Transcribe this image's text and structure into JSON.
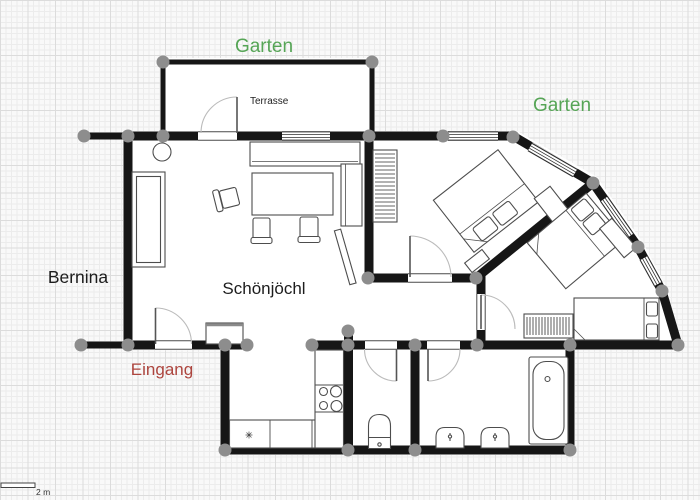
{
  "plan": {
    "labels": {
      "garten_top": {
        "text": "Garten",
        "color": "#56a556"
      },
      "garten_right": {
        "text": "Garten",
        "color": "#56a556"
      },
      "terrasse": {
        "text": "Terrasse",
        "color": "#222222"
      },
      "bernina": {
        "text": "Bernina",
        "color": "#1d1d1d"
      },
      "apartment": {
        "text": "Schönjöchl",
        "color": "#1d1d1d"
      },
      "eingang": {
        "text": "Eingang",
        "color": "#ad453e"
      }
    },
    "scale_bar": {
      "label": "2 m",
      "color": "#333333"
    },
    "colors": {
      "wall": "#161616",
      "floor": "#ffffff",
      "junction_dot": "#8d8d8d",
      "furniture_outline": "#4d4d4d",
      "grid_minor": "#ececec",
      "grid_major": "#dcdcdc",
      "background": "#f9f9f9"
    }
  }
}
